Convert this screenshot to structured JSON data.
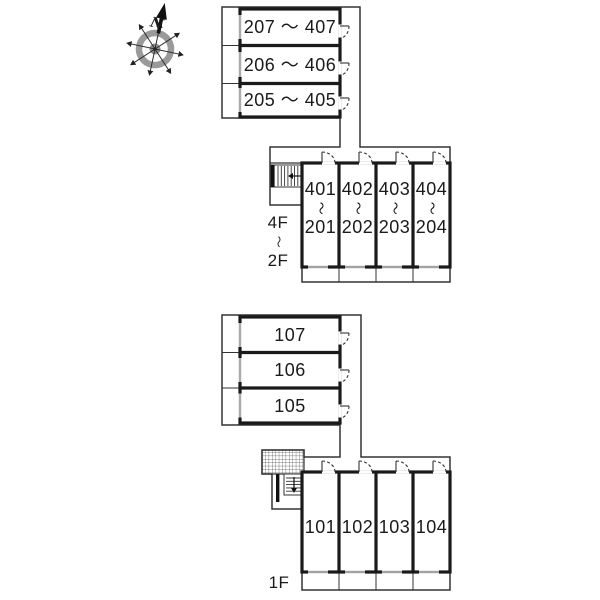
{
  "compass": {
    "north_label": "N"
  },
  "upper_building": {
    "side_rooms": [
      {
        "label": "207 ～ 407"
      },
      {
        "label": "206 ～ 406"
      },
      {
        "label": "205 ～ 405"
      }
    ],
    "units": [
      {
        "upper": "401",
        "lower": "201"
      },
      {
        "upper": "402",
        "lower": "202"
      },
      {
        "upper": "403",
        "lower": "203"
      },
      {
        "upper": "404",
        "lower": "204"
      }
    ],
    "unit_separator": "～",
    "floor_range": {
      "top": "4F",
      "separator": "～",
      "bottom": "2F"
    }
  },
  "lower_building": {
    "side_rooms": [
      {
        "label": "107"
      },
      {
        "label": "106"
      },
      {
        "label": "105"
      }
    ],
    "units": [
      {
        "label": "101"
      },
      {
        "label": "102"
      },
      {
        "label": "103"
      },
      {
        "label": "104"
      }
    ],
    "floor_label": "1F"
  },
  "colors": {
    "wall": "#1a1a1a",
    "thin_line": "#333333",
    "compass_gray": "#9a9a9a",
    "background": "#ffffff"
  }
}
